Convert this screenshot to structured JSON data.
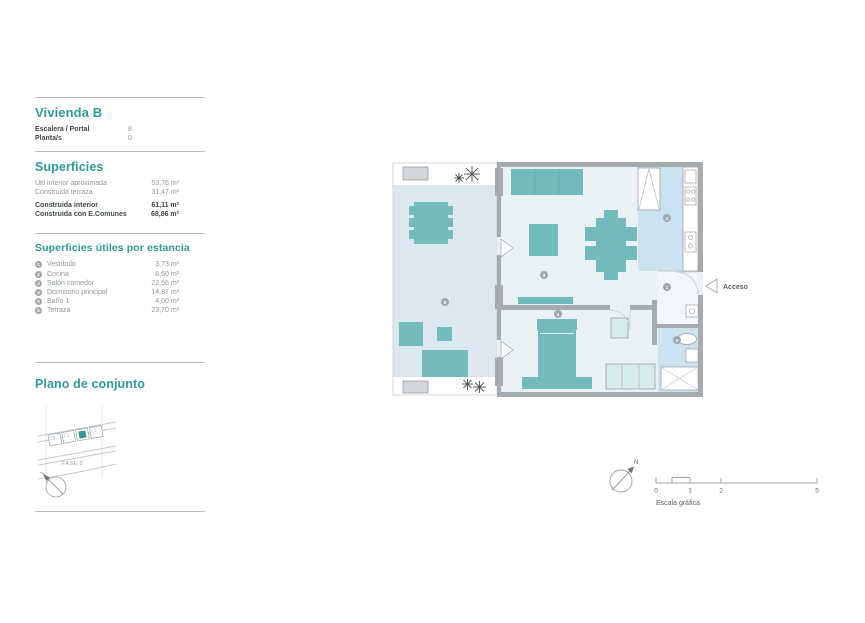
{
  "colors": {
    "accent": "#2e9b98",
    "furniture_teal": "#72babc",
    "wall_gray": "#a6abaf",
    "terrace_floor": "#dce8ef",
    "wet_floor": "#cbe2ef",
    "unit_floor": "#ebf2f5",
    "badge_gray": "#9fa8ae"
  },
  "sidebar": {
    "title": "Vivienda B",
    "info": [
      {
        "label": "Escalera / Portal",
        "value": "8"
      },
      {
        "label": "Planta/s",
        "value": "0"
      }
    ],
    "superficies": {
      "heading": "Superficies",
      "rows": [
        {
          "label": "Útil interior aproximada",
          "value": "53,76 m²"
        },
        {
          "label": "Construida terraza",
          "value": "31,47 m²"
        },
        {
          "label": "Construida interior",
          "value": "61,11 m²"
        },
        {
          "label": "Construida con E.Comunes",
          "value": "68,86 m²"
        }
      ]
    },
    "estancias": {
      "heading": "Superficies útiles por estancia",
      "rooms": [
        {
          "num": "1",
          "name": "Vestíbulo",
          "value": "3,73 m²"
        },
        {
          "num": "2",
          "name": "Cocina",
          "value": "8,60 m²"
        },
        {
          "num": "3",
          "name": "Salón comedor",
          "value": "22,56 m²"
        },
        {
          "num": "4",
          "name": "Dormitorio principal",
          "value": "14,87 m²"
        },
        {
          "num": "5",
          "name": "Baño 1",
          "value": "4,00 m²"
        },
        {
          "num": "6",
          "name": "Terraza",
          "value": "23,70 m²"
        }
      ]
    },
    "conjunto": {
      "heading": "Plano de conjunto",
      "fase_label": "FASE 2"
    }
  },
  "plan": {
    "acceso_label": "Acceso",
    "north_label": "N",
    "scale": {
      "caption": "Escala gráfica",
      "ticks": [
        "0",
        "1",
        "2",
        "5"
      ]
    }
  }
}
